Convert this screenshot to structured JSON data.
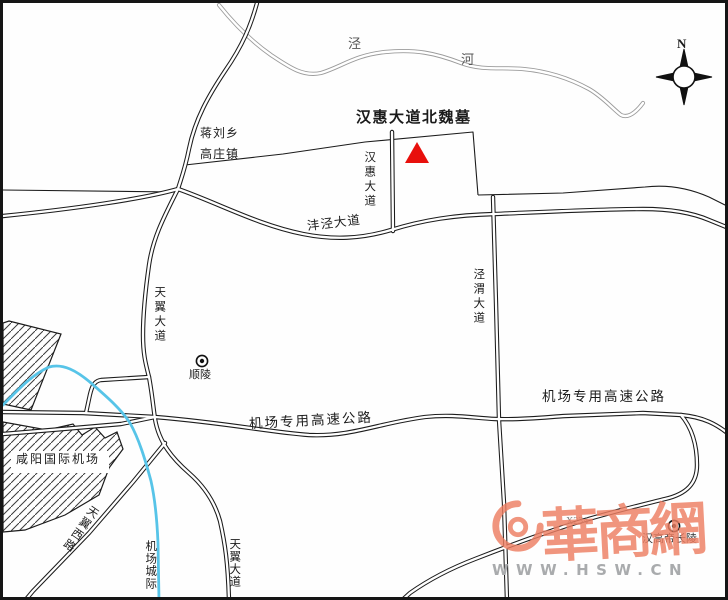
{
  "map": {
    "title": "汉惠大道北魏墓",
    "compass": {
      "north_label": "N"
    },
    "river": {
      "name": "泾河",
      "char_jing": "泾",
      "char_he": "河"
    },
    "towns": {
      "jiangliuxiang": "蒋刘乡",
      "gaozhuangzhen": "高庄镇"
    },
    "roads": {
      "hanhui": "汉惠大道",
      "fengjing": "沣泾大道",
      "jingwei": "泾渭大道",
      "tianyi_upper": "天翼大道",
      "tianyi_lower": "天翼大道",
      "tianyi_west": "天翼西路",
      "airport_expressway_center": "机场专用高速公路",
      "airport_expressway_right": "机场专用高速公路",
      "airport_intercity": "机场城际",
      "x234": "X234"
    },
    "pois": {
      "airport": "咸阳国际机场",
      "shunling": "顺陵",
      "changling": "汉高帝长陵"
    },
    "marker": {
      "type": "red-triangle",
      "site": "汉惠大道北魏墓"
    },
    "watermark": {
      "brand": "華商網",
      "url": "WWW.HSW.CN"
    },
    "colors": {
      "road_line": "#1c1c1c",
      "river_line": "#9b9b9b",
      "intercity_blue": "#57c4e8",
      "marker_red": "#e8100c",
      "watermark_red": "#ee7f63",
      "watermark_gray": "#a9abad"
    }
  }
}
